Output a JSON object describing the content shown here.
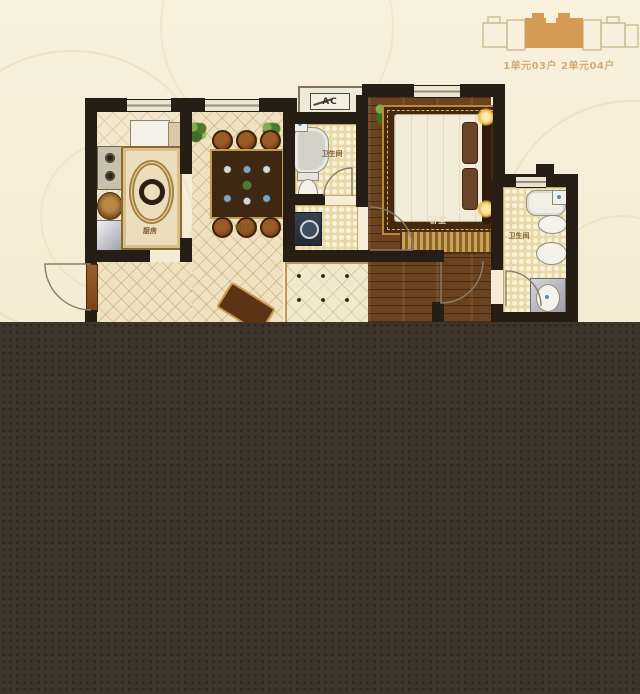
{
  "page": {
    "background_color": "#f8eeda",
    "overlay_color": "#3e352a"
  },
  "legend": {
    "units_label": "1单元03户 2单元04户",
    "highlight_color": "#d49b55",
    "outline_color": "#cdbb92"
  },
  "plan": {
    "ac_label": "AC",
    "rooms": [
      {
        "id": "kitchen",
        "label": "厨房"
      },
      {
        "id": "dining",
        "label": "餐厅"
      },
      {
        "id": "bathroom-1",
        "label": "卫生间"
      },
      {
        "id": "bedroom",
        "label": "卧室"
      },
      {
        "id": "bathroom-2",
        "label": "卫生间"
      }
    ],
    "colors": {
      "wall": "#261e15",
      "tile_floor": "#f0e2c0",
      "checker_floor": "#e7d8a6",
      "wood_floor": "#6b4220",
      "corridor_floor": "#f2e8cd"
    }
  }
}
